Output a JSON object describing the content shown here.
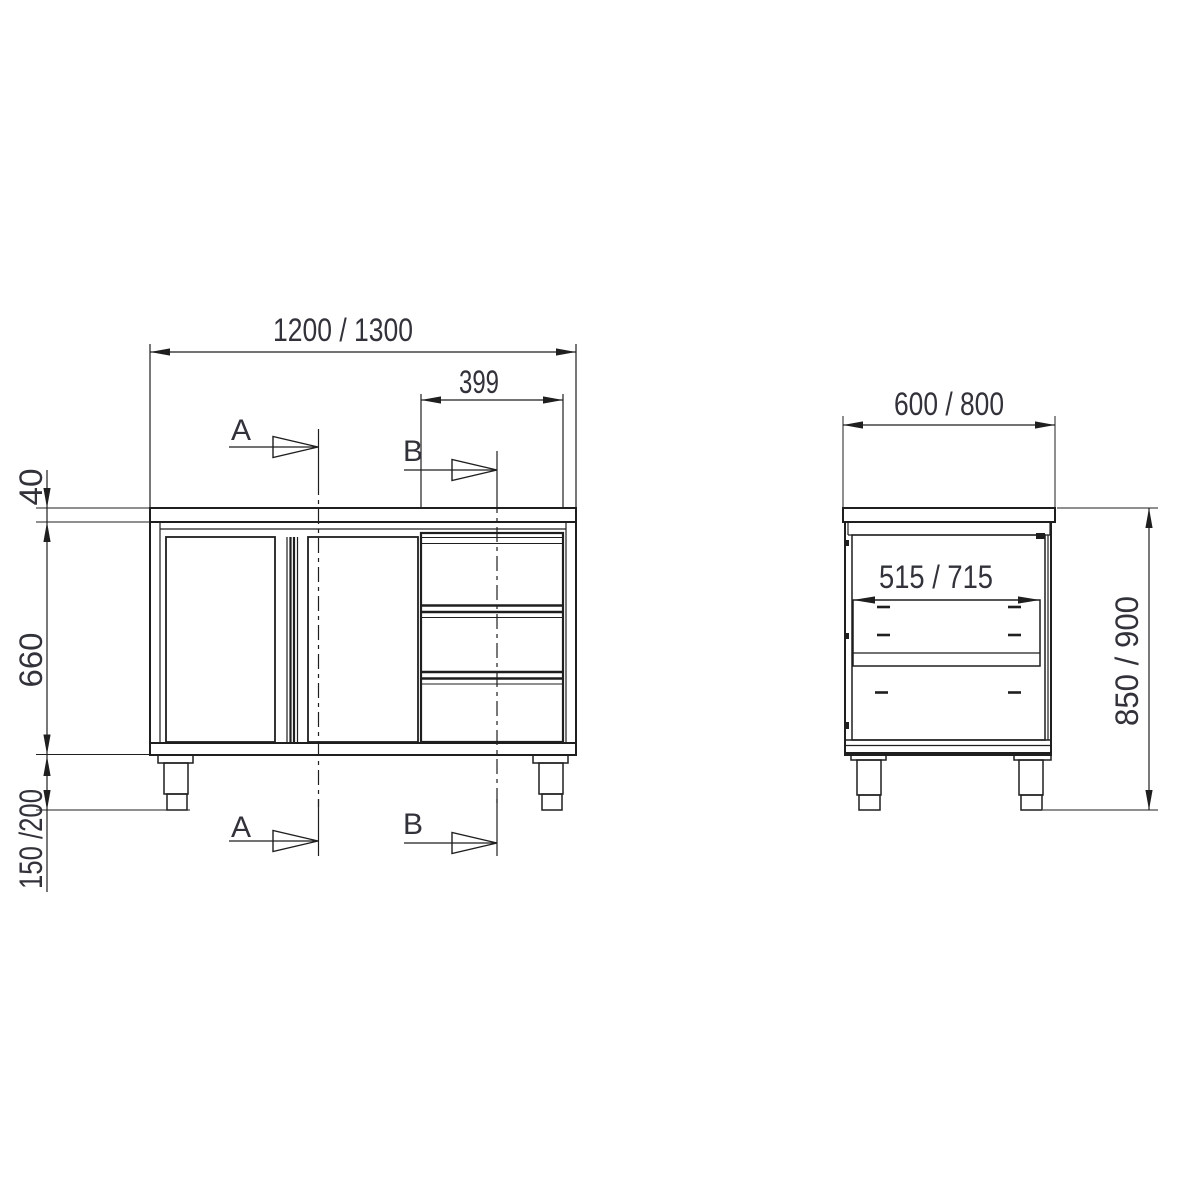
{
  "colors": {
    "line": "#1f1f1f",
    "dim_text": "#32323a",
    "background": "#ffffff"
  },
  "front_view": {
    "overall_width": "1200 / 1300",
    "drawer_section_width": "399",
    "worktop_thickness": "40",
    "body_height": "660",
    "leg_height": "150 /200",
    "section_a": "A",
    "section_b": "B"
  },
  "side_view": {
    "depth": "600 / 800",
    "inner_depth": "515 / 715",
    "overall_height": "850 / 900"
  }
}
